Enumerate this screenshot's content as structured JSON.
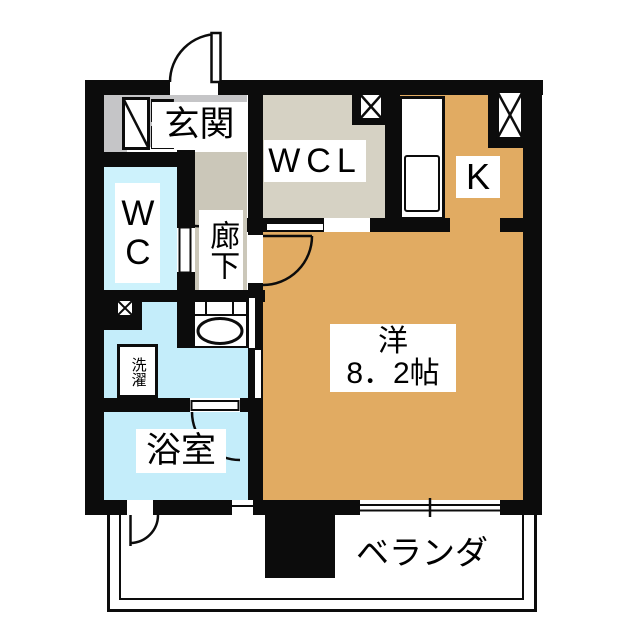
{
  "plan_title": "1K floor plan",
  "labels": {
    "genkan": "玄関",
    "wcl": "WCL",
    "kitchen": "K",
    "wc": "WC",
    "hallway": "廊下",
    "laundry": "洗濯",
    "bathroom": "浴室",
    "main_room_type": "洋",
    "main_room_size": "8．2帖",
    "veranda": "ベランダ"
  },
  "colors": {
    "wall": "#0c0c0c",
    "main_room_orange": "#e1ab62",
    "wc_blue": "#cdf2fc",
    "washroom_blue": "#c4edfa",
    "bathroom_blue": "#c4edfa",
    "genkan_gray": "#c5c5c7",
    "hallway_gray": "#cbc7b9",
    "wcl_beige": "#d6d2c4",
    "label_background": "#ffffff"
  },
  "symbols": [
    "entrance-door-swing",
    "shoe-cabinet",
    "pillar-x-top-right",
    "pillar-x-wcl",
    "pillar-x-left",
    "kitchen-counter",
    "kitchen-sink",
    "wc-door-swing",
    "room-door-swing",
    "sliding-door-wcl",
    "sliding-door-washroom",
    "vanity-sink",
    "washing-machine",
    "bath-door-swing",
    "veranda-door-swing",
    "sliding-window",
    "veranda-railing"
  ]
}
